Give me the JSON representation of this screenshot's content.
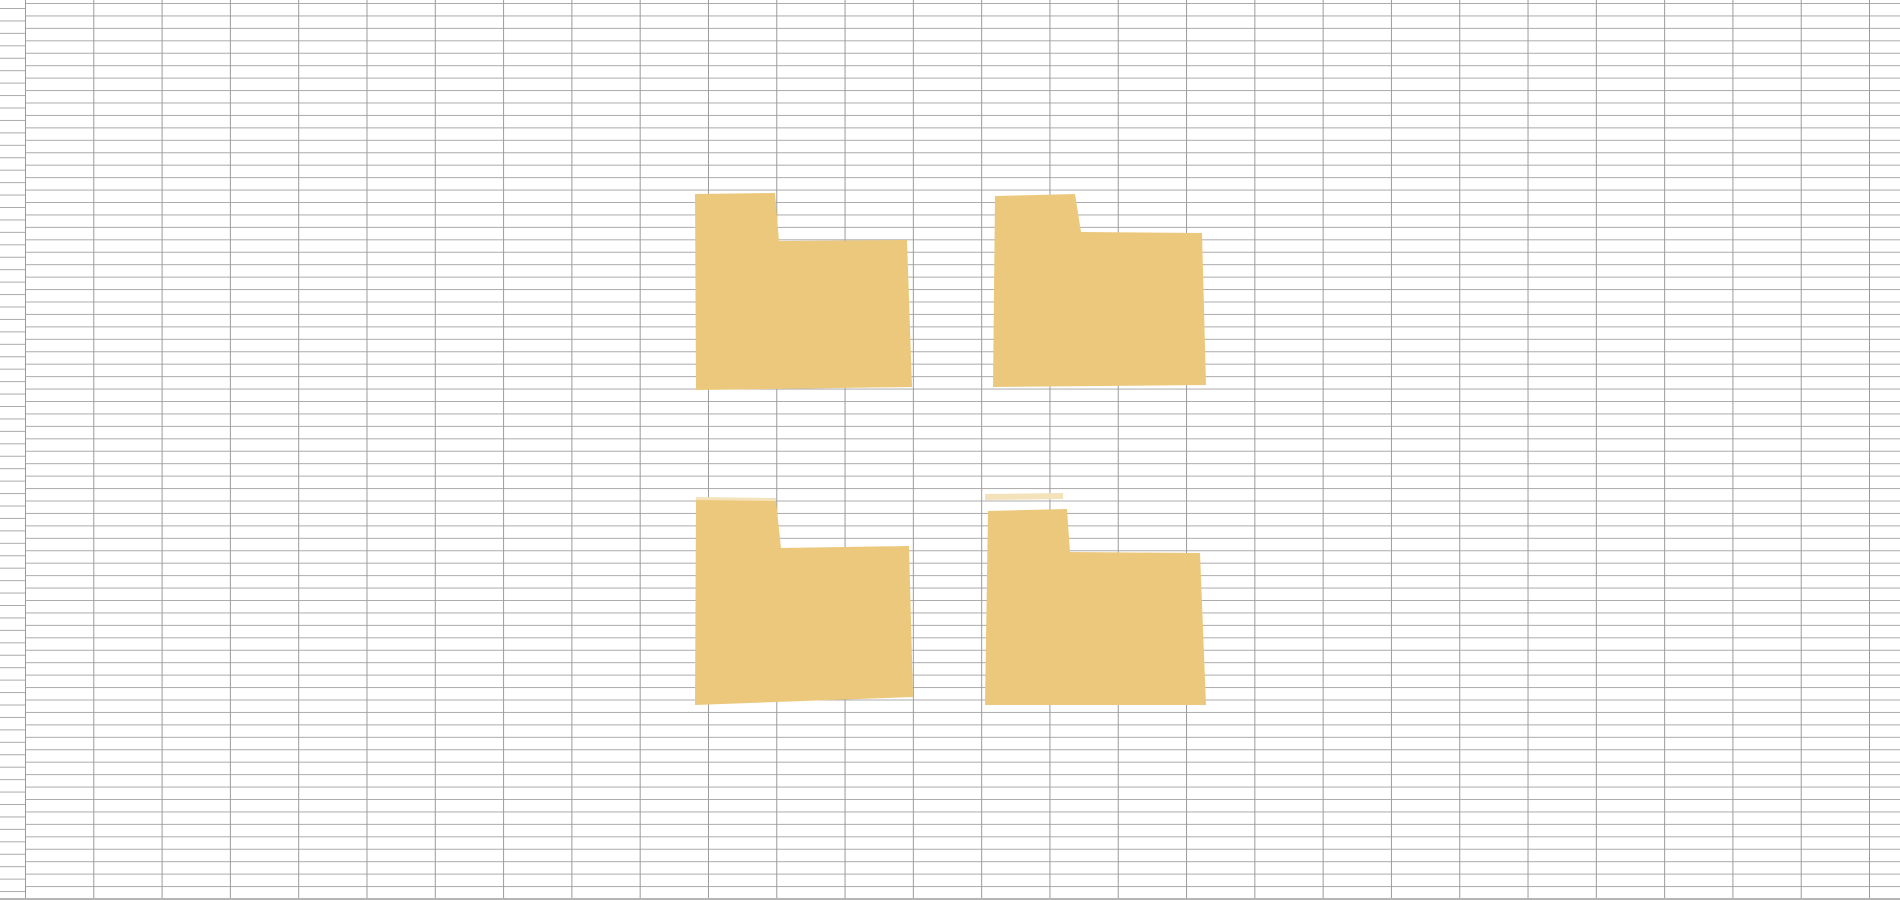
{
  "canvas": {
    "width": 1900,
    "height": 900,
    "background_color": "#ffffff"
  },
  "grid": {
    "column_width": 68.3,
    "row_height": 12.45,
    "first_vertical_line_x": 25,
    "first_horizontal_line_y": 3,
    "header_column_width": 25,
    "header_column_line_offset_y": 8,
    "vertical_line_color": "#9b9b9b",
    "horizontal_line_color": "#ababab",
    "bottom_edge_color": "#b5b5b5"
  },
  "shapes": {
    "fill_color": "#ecc87c",
    "faint_fill_color": "#f4e3ba",
    "folders": [
      {
        "name": "folder-top-left",
        "points": "695,194 775,193 779,241 907,240 912,387 696,390"
      },
      {
        "name": "folder-top-right",
        "points": "995,196 1075,194 1081,232 1202,233 1206,385 993,387"
      },
      {
        "name": "folder-bottom-left",
        "points": "696,500 776,501 781,548 909,546 913,697 695,705"
      },
      {
        "name": "folder-bottom-right",
        "points": "988,511 1067,509 1070,552 1200,553 1206,705 985,705"
      }
    ],
    "faint_fragments": [
      {
        "name": "faint-sliver-above-bottom-right-folder",
        "points": "985,494 1063,493 1063,499 985,500"
      },
      {
        "name": "faint-sliver-above-bottom-left-folder",
        "points": "696,497 776,498 776,501 696,501"
      }
    ]
  }
}
